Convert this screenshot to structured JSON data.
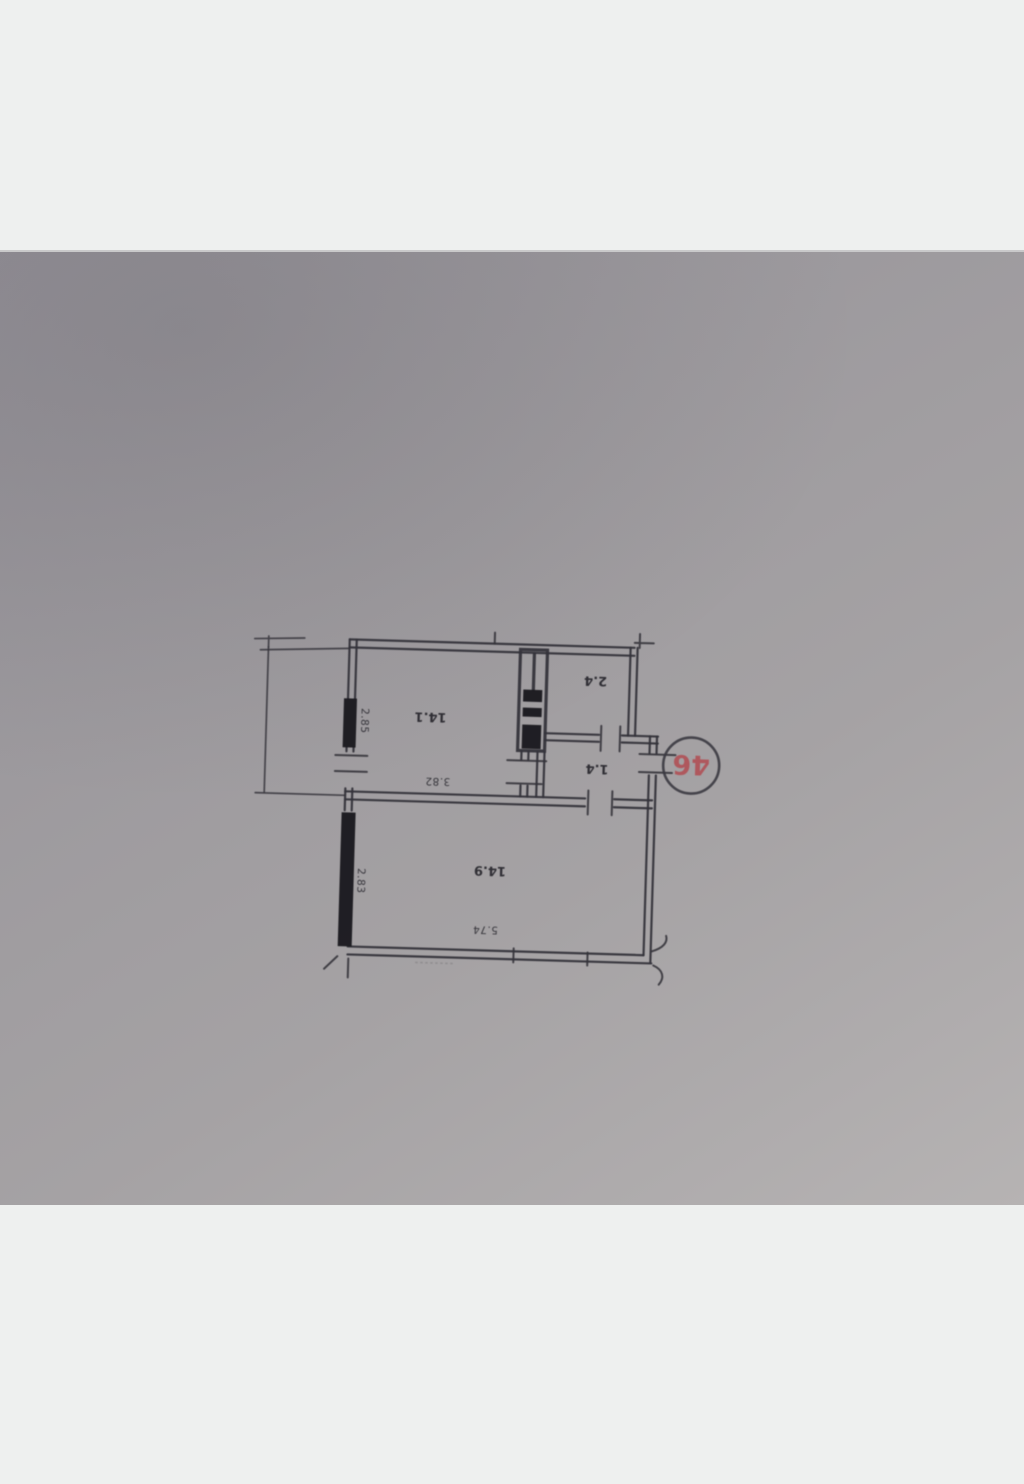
{
  "floor_plan": {
    "badge_number": "46",
    "rooms": [
      {
        "id": "room-top-left",
        "area": "14.1"
      },
      {
        "id": "room-top-right",
        "area": "2.4"
      },
      {
        "id": "room-middle",
        "area": "1.4"
      },
      {
        "id": "room-bottom",
        "area": "14.9"
      }
    ],
    "dimensions": {
      "left_upper": "2.85",
      "top_room_width": "3.82",
      "left_lower": "2.83",
      "bottom_room_width": "5.74"
    },
    "colors": {
      "paper": "#a19ea1",
      "ink": "#36353c",
      "badge_red": "#b04f55"
    }
  }
}
